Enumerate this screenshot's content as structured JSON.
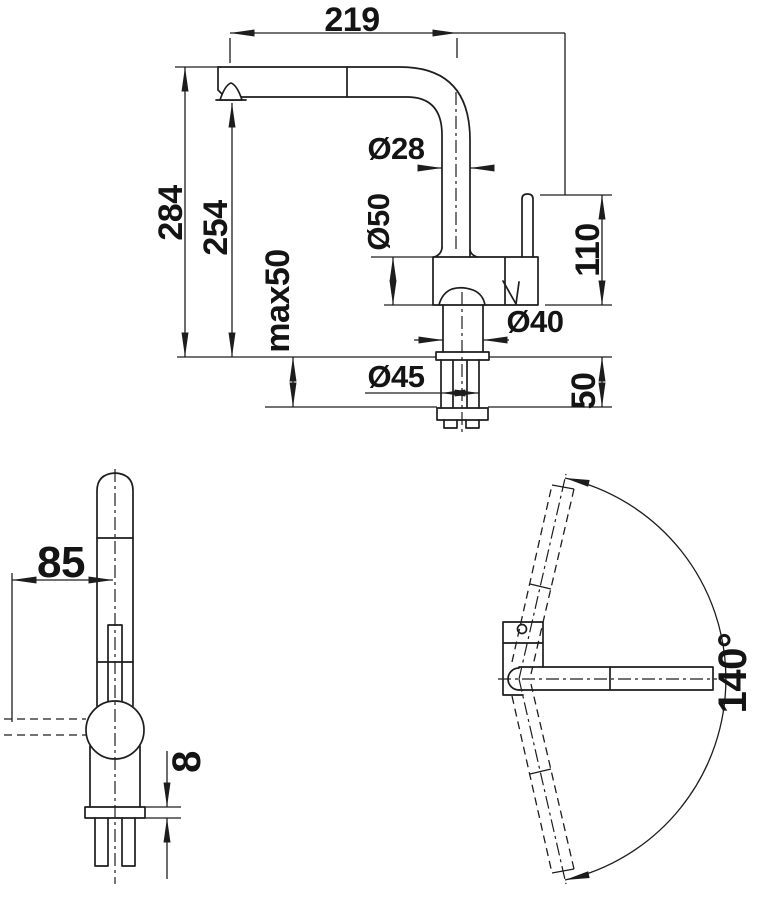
{
  "colors": {
    "line": "#1d1d1d",
    "text": "#141414",
    "background": "#ffffff"
  },
  "side_view": {
    "spout_reach": "219",
    "total_height": "284",
    "outlet_height": "254",
    "max_mounting_thickness": "max50",
    "spout_diameter": "Ø28",
    "body_diameter": "Ø50",
    "handle_height": "110",
    "shank_diameter": "Ø40",
    "hole_diameter": "Ø45",
    "under_counter_depth": "50"
  },
  "front_view": {
    "lever_reach": "85",
    "base_height": "8"
  },
  "plan_view": {
    "swivel_angle": "140°"
  }
}
